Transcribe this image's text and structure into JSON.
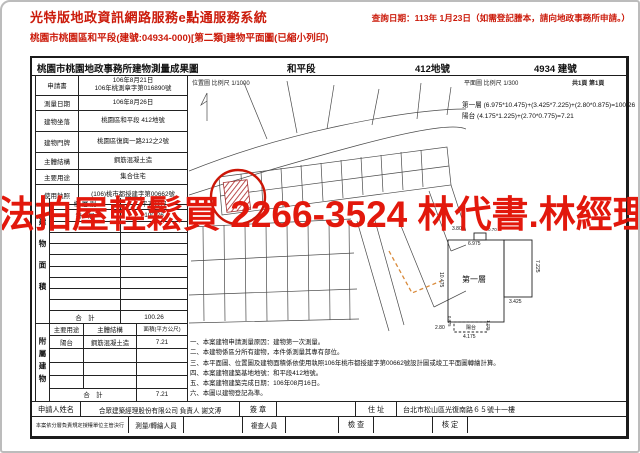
{
  "colors": {
    "header_red": "#cb1a0a",
    "watermark_red": "#e2180c",
    "target_red": "#cc1607"
  },
  "watermark": {
    "text": "法拍屋輕鬆買 2266-3524 林代書.林經理"
  },
  "header": {
    "system_title": "光特版地政資訊網路服務e點通服務系統",
    "query_date": "查詢日期：113年 1月23日（如需登記謄本，請向地政事務所申請。）",
    "subtitle": "桃園市桃園區和平段(建號:04934-000)[第二類]建物平面圖(已縮小列印)"
  },
  "doc": {
    "title": "桃園市桃園地政事務所建物測量成果圖",
    "section_label": "和平段",
    "lot_label": "412地號",
    "building_label": "4934 建號",
    "location_scale": "位置圖 比例尺 1/1000",
    "plan_scale": "平面圖 比例尺 1/300",
    "page_info": "共1頁 第1頁",
    "info": {
      "rows": [
        {
          "label": "申請書",
          "value": "106年8月21日\n106年桃測章字第016890號"
        },
        {
          "label": "測量日期",
          "value": "106年8月26日"
        },
        {
          "label": "建物坐落",
          "value": "桃園區和平段 412地號"
        },
        {
          "label": "建物門牌",
          "value": "桃園區復興一路212之2號"
        },
        {
          "label": "主體結構",
          "value": "鋼筋混凝土造"
        },
        {
          "label": "主要用途",
          "value": "集合住宅"
        },
        {
          "label": "使用執照",
          "value": "(106)桃市都授建字第00662號"
        }
      ]
    },
    "floor_area": {
      "side_label": "建物面積",
      "col_floor": "樓 層 別",
      "col_area": "平方公尺",
      "rows": [
        {
          "floor": "第一層",
          "area": "100.26"
        }
      ],
      "total_label": "合　計",
      "total": "100.26"
    },
    "annex": {
      "side_label": "附屬建物",
      "col_use": "主要用途",
      "col_structure": "主體結構",
      "col_area": "面積(平方公尺)",
      "rows": [
        {
          "use": "陽台",
          "structure": "鋼筋混凝土造",
          "area": "7.21"
        }
      ],
      "total_label": "合　計",
      "total": "7.21"
    },
    "formulas": [
      "第一層 (6.975*10.475)+(3.425*7.225)+(2.80*0.875)=100.26",
      "陽台 (4.175*1.225)+(2.70*0.775)=7.21"
    ],
    "notes": [
      "一、本案建物申請測量原因：建物第一次測量。",
      "二、本建物係區分所有建物，本件係測量其專有部位。",
      "三、本平面圖、位置圖及建物面積係依使用執照106年桃市都授建字第00662號設計圖或竣工平面圖轉繪計算。",
      "四、本案建物建築基地地號：和平段412地號。",
      "五、本案建物建築完成日期：106年08月16日。",
      "六、本圖以建物登記為準。"
    ],
    "floorplan": {
      "room_label": "第一層",
      "balcony_label": "陽台",
      "dims": {
        "left": "10.475",
        "top": "6.975",
        "top_a": "3.80",
        "top_b": "0.70",
        "right": "7.225",
        "ext_bottom": "3.425",
        "bottom": "4.175",
        "bottom_left": "2.80",
        "balcony_left": "0.875",
        "balcony_right": "1.225"
      }
    },
    "footer": {
      "applicant_label": "申請人姓名",
      "applicant": "合眾建築經理股份有限公司 負責人 謝文溥",
      "seal_label": "簽 章",
      "address_label": "住 址",
      "address": "台北市松山區光復南路６５號十一樓",
      "decision_note": "本案依分層負責規定授權單位主管決行",
      "surveyor_label": "測量/轉繪人員",
      "reviewer_label": "複查人員",
      "check_label": "檢 查",
      "approve_label": "核 定"
    }
  }
}
